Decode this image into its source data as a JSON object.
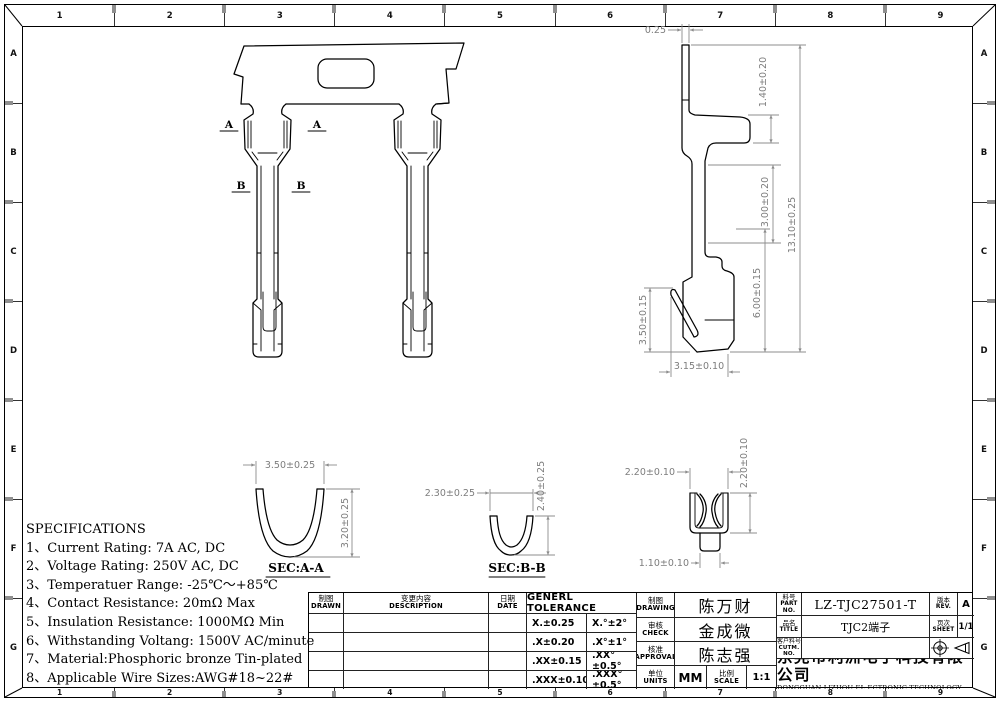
{
  "border": {
    "cols": [
      "1",
      "2",
      "3",
      "4",
      "5",
      "6",
      "7",
      "8",
      "9"
    ],
    "rows": [
      "A",
      "B",
      "C",
      "D",
      "E",
      "F",
      "G"
    ]
  },
  "specs": {
    "title": "SPECIFICATIONS",
    "items": [
      "1、Current Rating: 7A AC, DC",
      "2、Voltage Rating: 250V AC, DC",
      "3、Temperatuer Range: -25℃～+85℃",
      "4、Contact Resistance: 20mΩ Max",
      "5、Insulation Resistance: 1000MΩ Min",
      "6、Withstanding Voltang: 1500V AC/minute",
      "7、Material:Phosphoric bronze Tin-plated",
      "8、Applicable Wire Sizes:AWG#18~22#"
    ]
  },
  "front_view": {
    "cut_a": "A",
    "cut_b": "B"
  },
  "side_view": {
    "pin_width": "0.25",
    "flange_h": "1.40±0.20",
    "step_h": "3.00±0.20",
    "overall_h": "13.10±0.25",
    "lower_h": "6.00±0.15",
    "lance_h": "3.50±0.15",
    "bottom_w": "3.15±0.10"
  },
  "sections": {
    "aa": {
      "name": "SEC:A-A",
      "width": "3.50±0.25",
      "height": "3.20±0.25"
    },
    "bb": {
      "name": "SEC:B-B",
      "width": "2.30±0.25",
      "height": "2.40±0.25"
    },
    "clip": {
      "width": "2.20±0.10",
      "height": "2.20±0.10",
      "tab_width": "1.10±0.10"
    }
  },
  "title_block": {
    "rev_table": {
      "drawn_cn": "制图",
      "drawn_en": "DRAWN",
      "desc_cn": "变更内容",
      "desc_en": "DESCRIPTION",
      "date_cn": "日期",
      "date_en": "DATE"
    },
    "tolerance": {
      "title": "GENERL TOLERANCE",
      "rows": [
        [
          "X.±0.25",
          "X.°±2°"
        ],
        [
          ".X±0.20",
          ".X°±1°"
        ],
        [
          ".XX±0.15",
          ".XX°±0.5°"
        ],
        [
          ".XXX±0.10",
          ".XXX°±0.5°"
        ]
      ]
    },
    "sign": {
      "drawing_cn": "制图",
      "drawing_en": "DRAWING",
      "drawing_name": "陈万财",
      "check_cn": "审核",
      "check_en": "CHECK",
      "check_name": "金成微",
      "approval_cn": "核准",
      "approval_en": "APPROVAL",
      "approval_name": "陈志强",
      "units_cn": "单位",
      "units_en": "UNITS",
      "units_val": "MM",
      "scale_cn": "比例",
      "scale_en": "SCALE",
      "scale_val": "1:1"
    },
    "part": {
      "part_no_cn": "料号",
      "part_no_en": "PART NO.",
      "part_no": "LZ-TJC27501-T",
      "rev_cn": "版本",
      "rev_en": "REV.",
      "rev": "A",
      "title_cn": "品名",
      "title_en": "TITLE",
      "title": "TJC2端子",
      "sheet_cn": "页次",
      "sheet_en": "SHEET",
      "sheet": "1/1",
      "cust_cn": "客户料号",
      "cust_en": "CUTM. NO.",
      "company_cn": "东莞市利洲电子科技有限公司",
      "company_en": "DONGGUAN LIZHOU EL ECTRONIC TECHNOLOGY CO.,LID"
    }
  }
}
